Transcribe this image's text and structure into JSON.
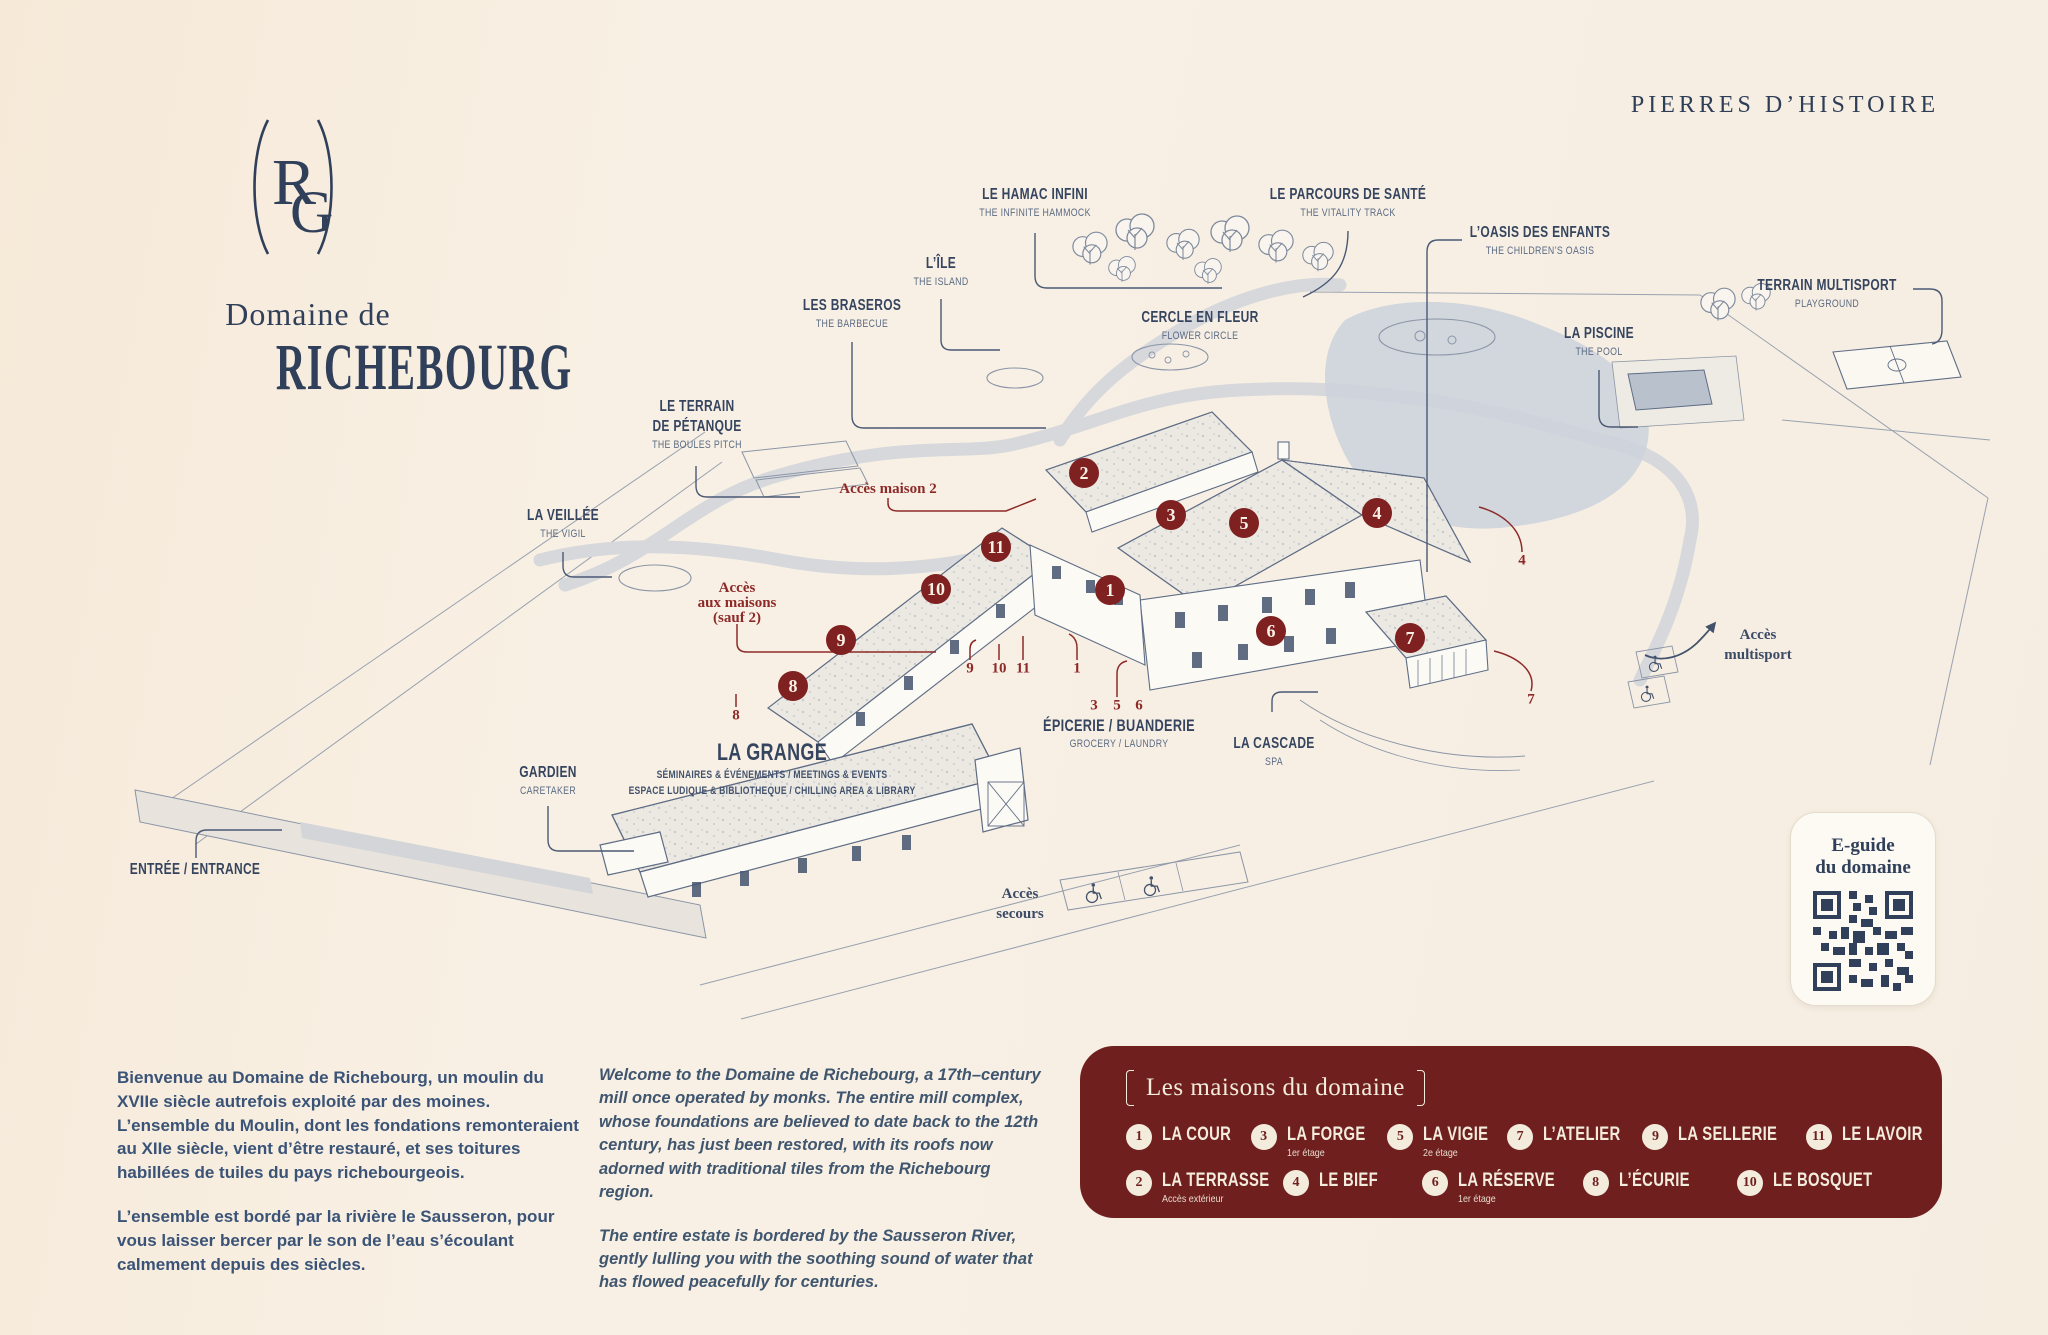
{
  "header": {
    "monogram": "RG",
    "title_prefix": "Domaine de",
    "title": "RICHEBOURG",
    "brand": "PIERRES D’HISTOIRE"
  },
  "map": {
    "pois": [
      {
        "fr": "LE HAMAC INFINI",
        "en": "THE INFINITE HAMMOCK"
      },
      {
        "fr": "LE PARCOURS DE SANTÉ",
        "en": "THE VITALITY TRACK"
      },
      {
        "fr": "L’OASIS DES ENFANTS",
        "en": "THE CHILDREN’S OASIS"
      },
      {
        "fr": "L’ÎLE",
        "en": "THE ISLAND"
      },
      {
        "fr": "LES BRASEROS",
        "en": "THE BARBECUE"
      },
      {
        "fr": "CERCLE EN FLEUR",
        "en": "FLOWER CIRCLE"
      },
      {
        "fr": "LA PISCINE",
        "en": "THE POOL"
      },
      {
        "fr": "TERRAIN MULTISPORT",
        "en": "PLAYGROUND"
      },
      {
        "fr1": "LE TERRAIN",
        "fr2": "DE PÉTANQUE",
        "en": "THE BOULES PITCH"
      },
      {
        "fr": "LA VEILLÉE",
        "en": "THE VIGIL"
      },
      {
        "fr": "LA GRANGE",
        "sub1": "SÉMINAIRES & ÉVÉNEMENTS / MEETINGS & EVENTS",
        "sub2": "ESPACE LUDIQUE & BIBLIOTHEQUE / CHILLING AREA & LIBRARY"
      },
      {
        "fr": "ÉPICERIE / BUANDERIE",
        "en": "GROCERY / LAUNDRY"
      },
      {
        "fr": "LA CASCADE",
        "en": "SPA"
      },
      {
        "fr": "GARDIEN",
        "en": "CARETAKER"
      },
      {
        "fr": "ENTRÉE / ENTRANCE"
      }
    ],
    "red_notes": {
      "maison2": "Accès maison 2",
      "group_l1": "Accès",
      "group_l2": "aux maisons",
      "group_l3": "(sauf 2)"
    },
    "nav_notes": {
      "secours_l1": "Accès",
      "secours_l2": "secours",
      "multi_l1": "Accès",
      "multi_l2": "multisport"
    },
    "markers": [
      "1",
      "2",
      "3",
      "4",
      "5",
      "6",
      "7",
      "8",
      "9",
      "10",
      "11"
    ],
    "leader_numbers": [
      "9",
      "10",
      "11",
      "1",
      "8",
      "3",
      "5",
      "6",
      "4",
      "7"
    ]
  },
  "qr": {
    "line1": "E-guide",
    "line2": "du domaine"
  },
  "intro": {
    "fr": [
      "Bienvenue au Domaine de Richebourg, un moulin du XVIIe siècle autrefois exploité par des moines. L’ensemble du Moulin, dont les fondations remonteraient au XIIe siècle, vient d’être restauré, et ses toitures habillées de tuiles du pays richebourgeois.",
      "L’ensemble est bordé par la rivière le Sausseron, pour vous laisser bercer par le son de l’eau s’écoulant calmement depuis des siècles."
    ],
    "en": [
      "Welcome to the Domaine de Richebourg, a 17th–century mill once operated by monks. The entire mill complex, whose foundations are believed to date back to the 12th century, has just been restored, with its roofs now adorned with traditional tiles from the Richebourg region.",
      "The entire estate is bordered by the Sausseron River, gently lulling you with the soothing sound of water that has flowed peacefully for centuries."
    ]
  },
  "legend": {
    "title": "Les maisons du domaine",
    "items": [
      {
        "num": "1",
        "label": "LA COUR",
        "note": ""
      },
      {
        "num": "2",
        "label": "LA TERRASSE",
        "note": "Accès extérieur"
      },
      {
        "num": "3",
        "label": "LA FORGE",
        "note": "1er étage"
      },
      {
        "num": "4",
        "label": "LE BIEF",
        "note": ""
      },
      {
        "num": "5",
        "label": "LA VIGIE",
        "note": "2e étage"
      },
      {
        "num": "6",
        "label": "LA RÉSERVE",
        "note": "1er étage"
      },
      {
        "num": "7",
        "label": "L’ATELIER",
        "note": ""
      },
      {
        "num": "8",
        "label": "L’ÉCURIE",
        "note": ""
      },
      {
        "num": "9",
        "label": "LA SELLERIE",
        "note": ""
      },
      {
        "num": "10",
        "label": "LE BOSQUET",
        "note": ""
      },
      {
        "num": "11",
        "label": "LE LAVOIR",
        "note": ""
      }
    ]
  },
  "colors": {
    "background": "#f7efe4",
    "ink_navy": "#33425c",
    "legend_maroon": "#6e1f1e",
    "marker_red": "#7e2120",
    "note_red": "#8d2a28",
    "cream": "#f3ecdc"
  }
}
